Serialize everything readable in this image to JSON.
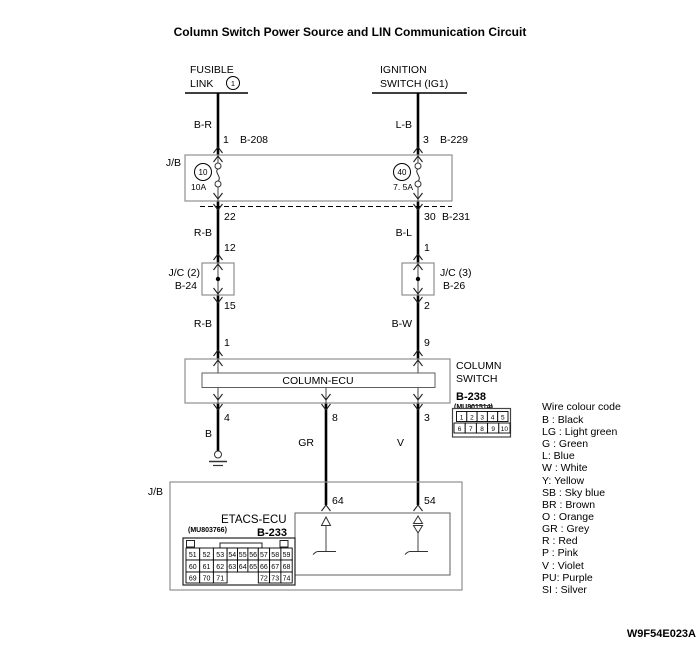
{
  "title": "Column Switch Power Source and LIN Communication Circuit",
  "doc_code": "W9F54E023A",
  "fusible_link": {
    "line1": "FUSIBLE",
    "line2": "LINK",
    "circle_num": "1"
  },
  "ignition": {
    "line1": "IGNITION",
    "line2": "SWITCH (IG1)"
  },
  "jb_top": {
    "label": "J/B",
    "fuse_left": {
      "num": "10",
      "rating": "10A"
    },
    "fuse_right": {
      "num": "40",
      "rating": "7. 5A"
    }
  },
  "left_branch": {
    "wire_top": "B-R",
    "pin_top": "1",
    "conn_top": "B-208",
    "pin_jb_out": "22",
    "wire_mid": "R-B",
    "pin_jc_in": "12",
    "jc_label": "J/C (2)",
    "jc_conn": "B-24",
    "pin_jc_out": "15",
    "wire_low": "R-B",
    "pin_ecu_in": "1",
    "pin_ecu_out": "4",
    "wire_gnd": "B"
  },
  "right_branch": {
    "wire_top": "L-B",
    "pin_top": "3",
    "conn_top": "B-229",
    "pin_jb_out": "30",
    "conn_jb_out": "B-231",
    "wire_mid": "B-L",
    "pin_jc_in": "1",
    "jc_label": "J/C (3)",
    "jc_conn": "B-26",
    "pin_jc_out": "2",
    "wire_low": "B-W",
    "pin_ecu_in": "9",
    "pin_ecu_out": "3",
    "wire_out": "V",
    "pin_etacs": "54"
  },
  "mid_branch": {
    "pin_ecu_out": "8",
    "wire_out": "GR",
    "pin_etacs": "64"
  },
  "column_switch": {
    "ecu_label": "COLUMN-ECU",
    "name1": "COLUMN",
    "name2": "SWITCH",
    "conn": "B-238",
    "part": "(MU801514)",
    "pins_row1": [
      "1",
      "2",
      "3",
      "4",
      "5"
    ],
    "pins_row2": [
      "6",
      "7",
      "8",
      "9",
      "10"
    ]
  },
  "jb_bottom": {
    "label": "J/B",
    "ecu": "ETACS-ECU",
    "part": "(MU803766)",
    "conn": "B-233",
    "grid_row1": [
      "51",
      "52",
      "53",
      "54",
      "55",
      "56",
      "57",
      "58",
      "59"
    ],
    "grid_row2": [
      "60",
      "61",
      "62",
      "63",
      "64",
      "65",
      "66",
      "67",
      "68"
    ],
    "grid_row3_left": [
      "69",
      "70",
      "71"
    ],
    "grid_row3_right": [
      "72",
      "73",
      "74"
    ]
  },
  "legend": {
    "title": "Wire colour code",
    "items": [
      "B : Black",
      "LG : Light green",
      "G : Green",
      "L: Blue",
      "W : White",
      "Y: Yellow",
      "SB : Sky blue",
      "BR : Brown",
      "O : Orange",
      "GR : Grey",
      "R : Red",
      "P : Pink",
      "V : Violet",
      "PU: Purple",
      "SI : Silver"
    ]
  }
}
